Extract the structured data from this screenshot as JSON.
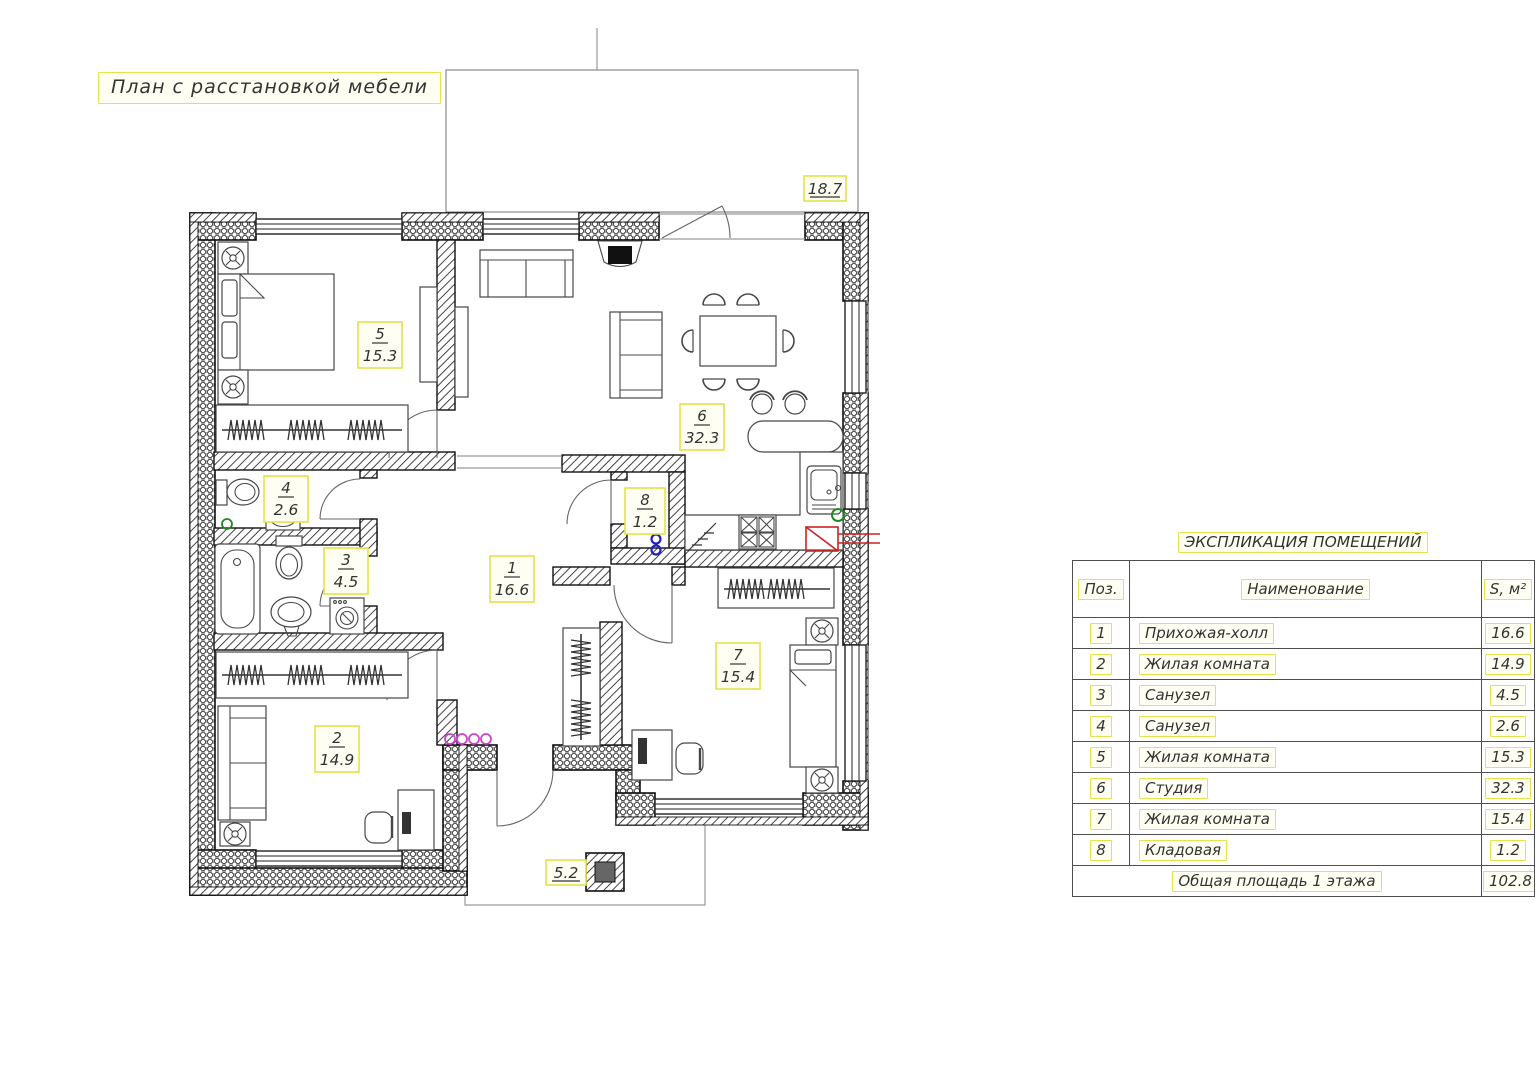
{
  "title": "План с расстановкой мебели",
  "plan": {
    "terrace_area": "18.7",
    "porch_area": "5.2",
    "room_labels": [
      {
        "num": "1",
        "area": "16.6"
      },
      {
        "num": "2",
        "area": "14.9"
      },
      {
        "num": "3",
        "area": "4.5"
      },
      {
        "num": "4",
        "area": "2.6"
      },
      {
        "num": "5",
        "area": "15.3"
      },
      {
        "num": "6",
        "area": "32.3"
      },
      {
        "num": "7",
        "area": "15.4"
      },
      {
        "num": "8",
        "area": "1.2"
      }
    ]
  },
  "schedule": {
    "title": "ЭКСПЛИКАЦИЯ ПОМЕЩЕНИЙ",
    "columns": {
      "pos": "Поз.",
      "name": "Наименование",
      "area": "S, м²"
    },
    "rows": [
      {
        "pos": "1",
        "name": "Прихожая-холл",
        "area": "16.6"
      },
      {
        "pos": "2",
        "name": "Жилая комната",
        "area": "14.9"
      },
      {
        "pos": "3",
        "name": "Санузел",
        "area": "4.5"
      },
      {
        "pos": "4",
        "name": "Санузел",
        "area": "2.6"
      },
      {
        "pos": "5",
        "name": "Жилая комната",
        "area": "15.3"
      },
      {
        "pos": "6",
        "name": "Студия",
        "area": "32.3"
      },
      {
        "pos": "7",
        "name": "Жилая комната",
        "area": "15.4"
      },
      {
        "pos": "8",
        "name": "Кладовая",
        "area": "1.2"
      }
    ],
    "footer": {
      "label": "Общая площадь 1 этажа",
      "value": "102.8"
    }
  },
  "colors": {
    "highlight_border": "#e3e34e",
    "line": "#333333",
    "accent_red": "#cc2222",
    "accent_blue": "#2222bb",
    "accent_magenta": "#cc44cc",
    "accent_green": "#228822"
  }
}
